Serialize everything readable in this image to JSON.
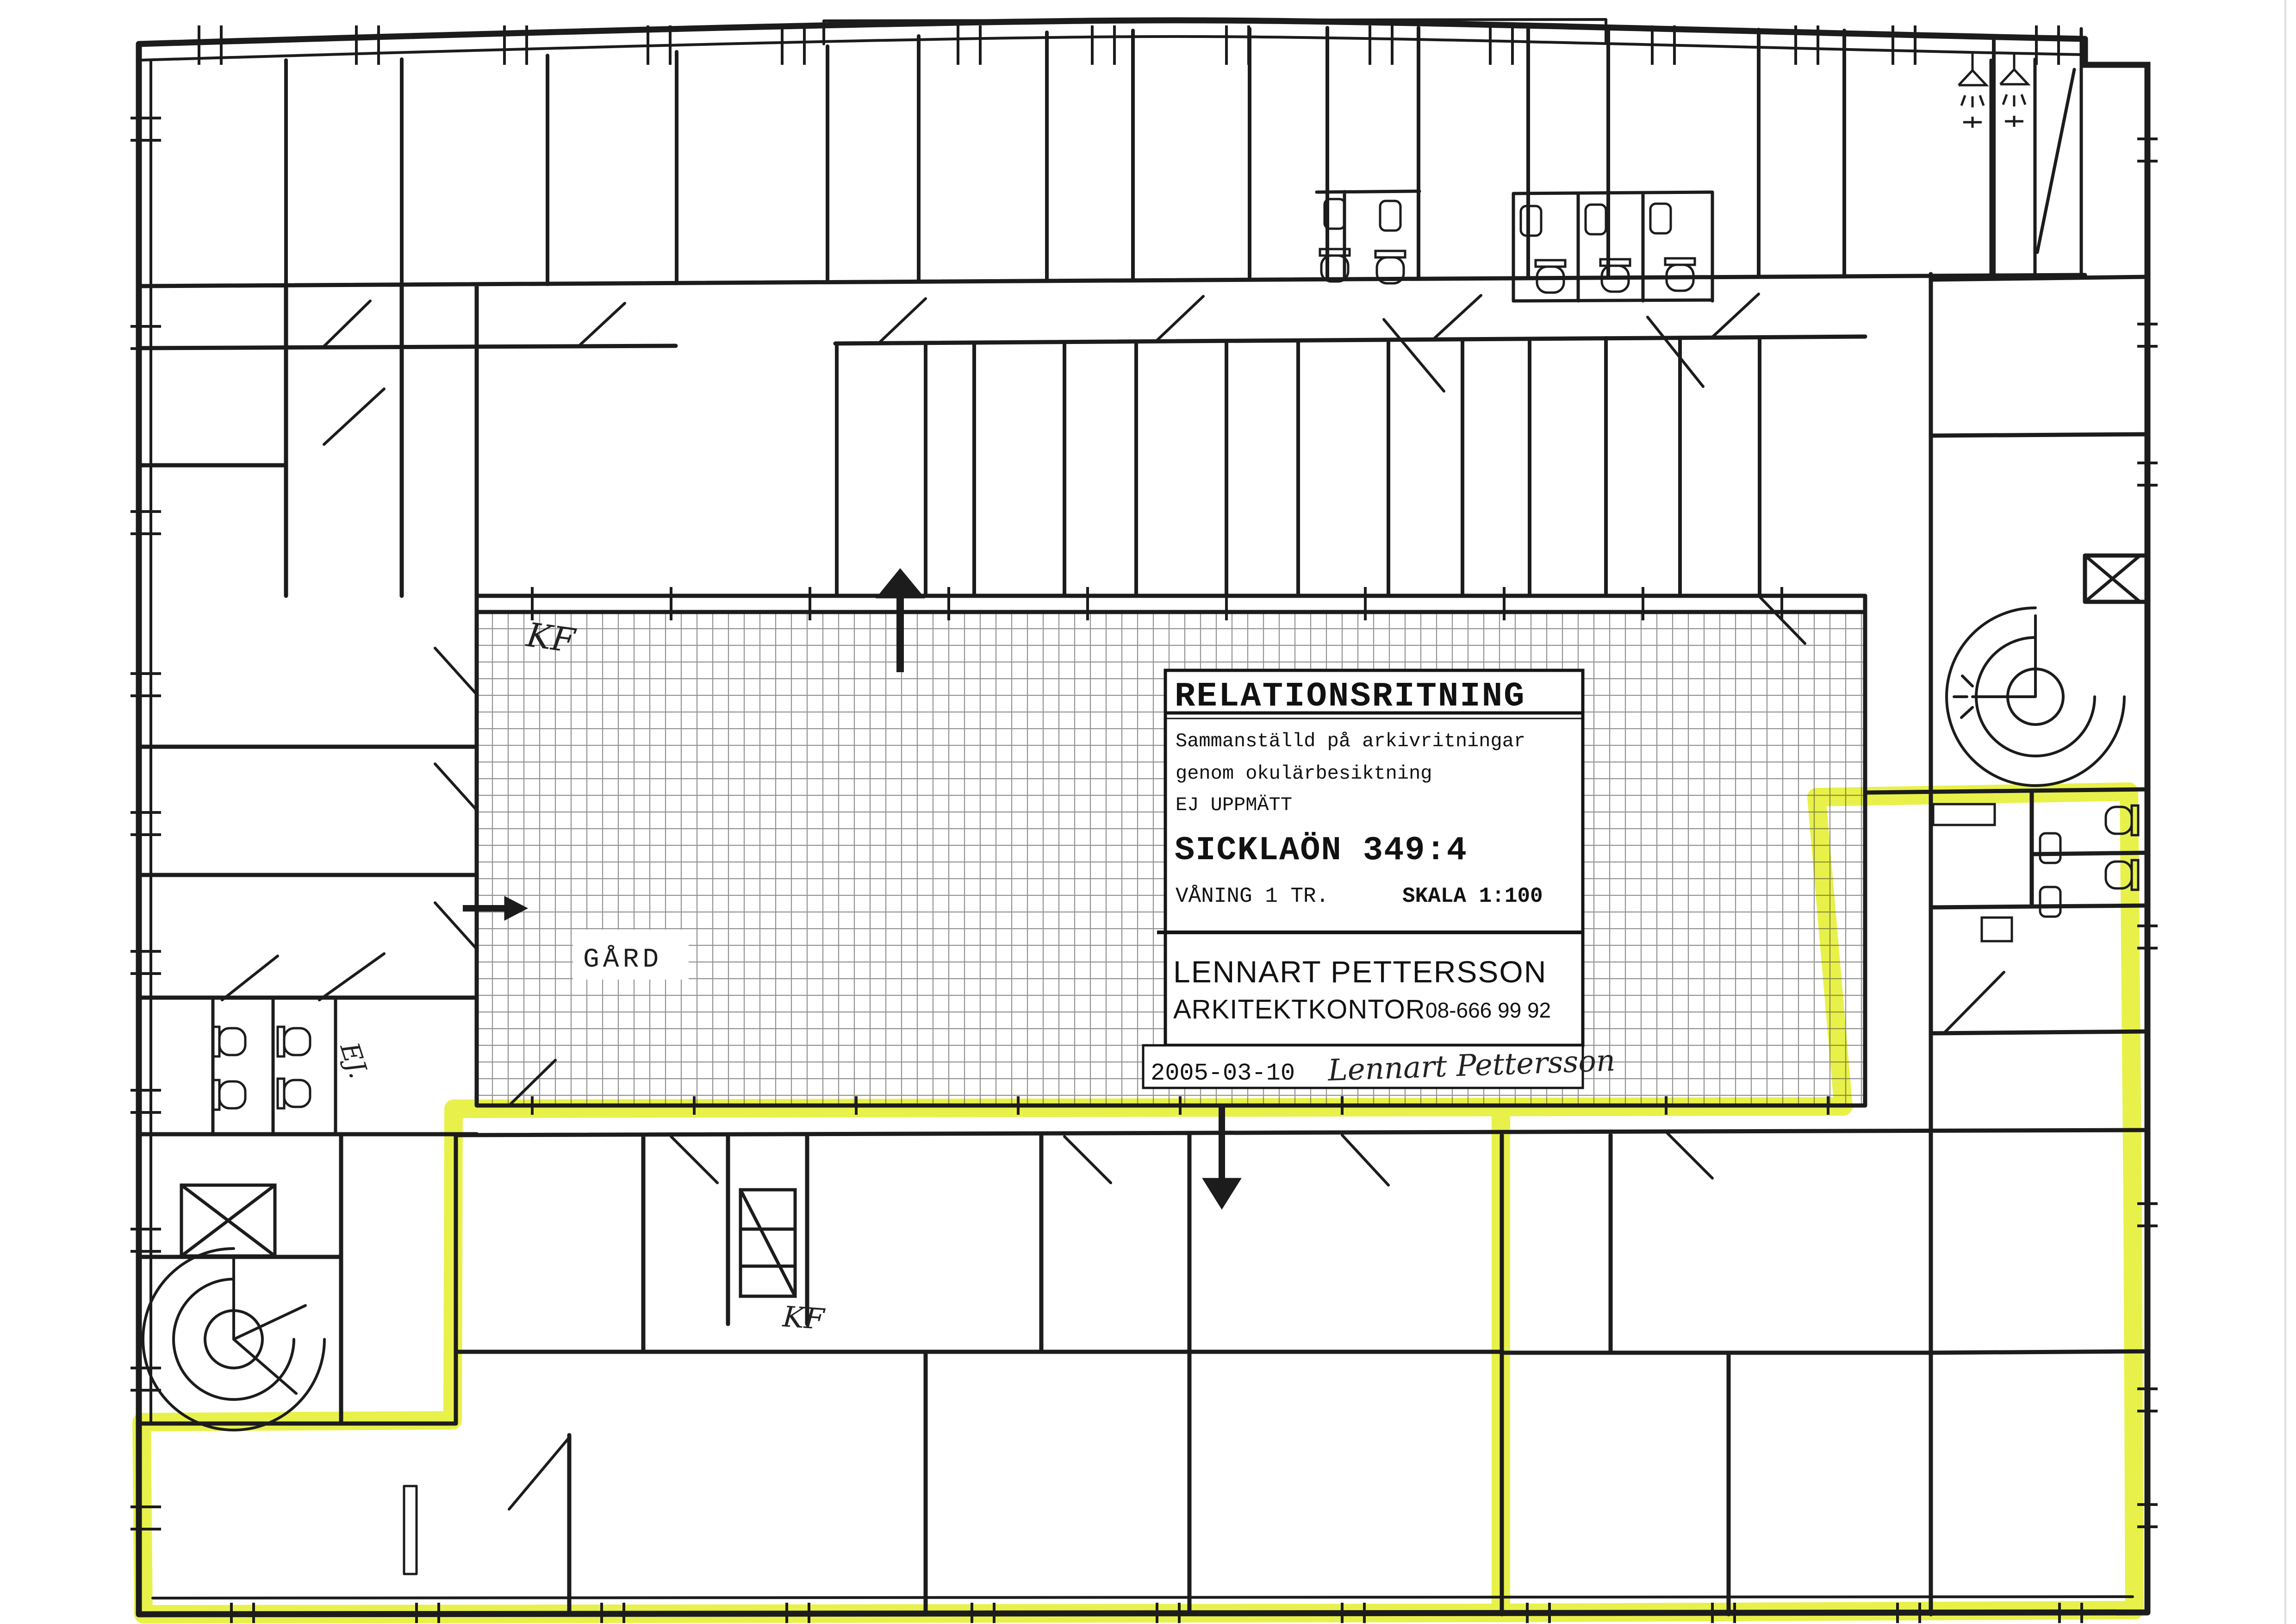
{
  "sheet": {
    "kind": "scanned architectural floor plan",
    "paper_color": "#ffffff",
    "ink_color": "#1c1c1c",
    "highlight_color": "#e4ef2a"
  },
  "title_block": {
    "heading": "RELATIONSRITNING",
    "note_line1": "Sammanställd på arkivritningar",
    "note_line2": "genom okulärbesiktning",
    "note_line3": "EJ UPPMÄTT",
    "property": "SICKLAÖN 349:4",
    "floor": "VÅNING 1 TR.",
    "scale": "SKALA 1:100",
    "firm_name": "LENNART PETTERSSON",
    "firm_type": "ARKITEKTKONTOR",
    "phone": "08-666 99 92",
    "date": "2005-03-10",
    "signature": "Lennart Pettersson"
  },
  "plan_labels": {
    "courtyard": "GÅRD",
    "kf_upper": "KF",
    "kf_lower": "KF",
    "ej_note": "EJ."
  },
  "legend_icons": [
    "spiral-stair-icon",
    "elevator-cross-icon",
    "toilet-icon",
    "sink-icon",
    "shower-icon",
    "entrance-arrow-icon",
    "door-swing-icon"
  ]
}
